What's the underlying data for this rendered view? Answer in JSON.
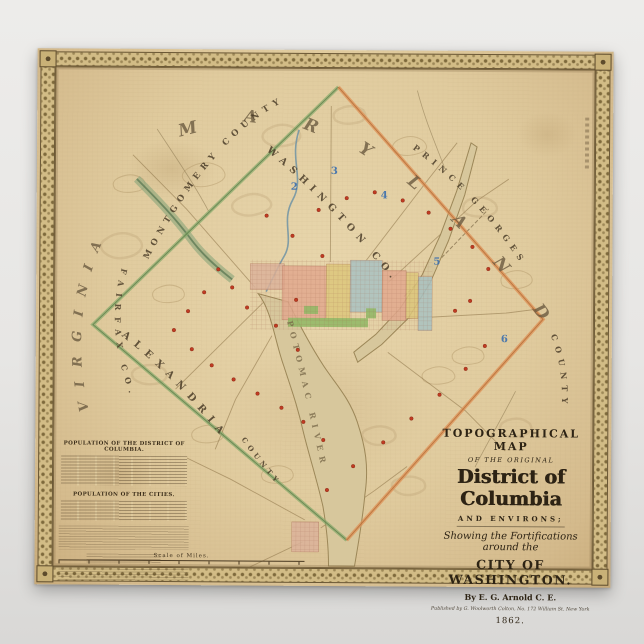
{
  "title_block": {
    "line1": "TOPOGRAPHICAL MAP",
    "line2": "OF THE ORIGINAL",
    "line3": "District of Columbia",
    "line4": "AND ENVIRONS;",
    "line5": "Showing the Fortifications around the",
    "line6": "CITY OF WASHINGTON.",
    "line7": "By E. G. Arnold C. E.",
    "line8": "Published by G. Woolworth Colton, No. 172 William St. New York",
    "line9": "1862."
  },
  "labels": {
    "maryland": "MARYLAND",
    "virginia": "VIRGINIA",
    "montgomery_county": "MONTGOMERY COUNTY",
    "prince_georges": "PRINCE GEORGES",
    "county_se": "COUNTY",
    "fairfax": "FAIRFAX CO.",
    "washington_co": "WASHINGTON CO.",
    "alexandria": "ALEXANDRIA",
    "alexandria_county": "COUNTY",
    "potomac_river": "POTOMAC RIVER"
  },
  "stats": {
    "table1_title": "POPULATION OF THE DISTRICT OF COLUMBIA.",
    "table2_title": "POPULATION OF THE CITIES.",
    "scale_label": "Scale of Miles."
  },
  "map": {
    "numbers": [
      {
        "n": "2",
        "x": 254,
        "y": 140
      },
      {
        "n": "3",
        "x": 294,
        "y": 124
      },
      {
        "n": "4",
        "x": 344,
        "y": 148
      },
      {
        "n": "5",
        "x": 397,
        "y": 214
      },
      {
        "n": "6",
        "x": 465,
        "y": 291
      }
    ],
    "forts": [
      [
        211,
        258
      ],
      [
        196,
        238
      ],
      [
        182,
        220
      ],
      [
        168,
        243
      ],
      [
        152,
        262
      ],
      [
        138,
        281
      ],
      [
        156,
        300
      ],
      [
        176,
        316
      ],
      [
        198,
        330
      ],
      [
        222,
        344
      ],
      [
        246,
        358
      ],
      [
        268,
        372
      ],
      [
        288,
        390
      ],
      [
        262,
        300
      ],
      [
        240,
        276
      ],
      [
        260,
        250
      ],
      [
        286,
        206
      ],
      [
        256,
        186
      ],
      [
        230,
        166
      ],
      [
        282,
        160
      ],
      [
        310,
        148
      ],
      [
        338,
        142
      ],
      [
        366,
        150
      ],
      [
        392,
        162
      ],
      [
        414,
        178
      ],
      [
        436,
        196
      ],
      [
        452,
        218
      ],
      [
        434,
        250
      ],
      [
        419,
        260
      ],
      [
        449,
        295
      ],
      [
        430,
        318
      ],
      [
        404,
        344
      ],
      [
        376,
        368
      ],
      [
        348,
        392
      ],
      [
        318,
        416
      ],
      [
        292,
        440
      ]
    ],
    "colors": {
      "boundary_green": "#85a969",
      "boundary_orange": "#dd9055",
      "ward_pink": "#e2a98e",
      "ward_yellow": "#ddc77c",
      "ward_blue": "#a9c2c2",
      "park_green": "#94b867",
      "fort_red": "#c03b22",
      "number_blue": "#3b6fae",
      "paper": "#e0cb9e",
      "frame": "#d2bc86"
    }
  }
}
